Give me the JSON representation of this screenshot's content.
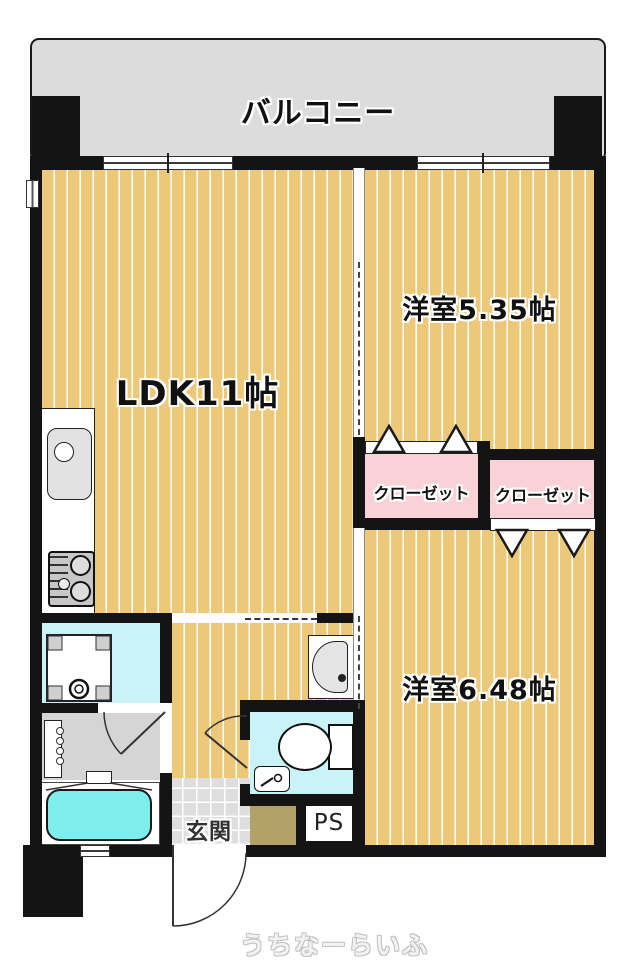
{
  "floorplan": {
    "balcony": {
      "label": "バルコニー"
    },
    "rooms": {
      "ldk": {
        "label": "LDK11帖"
      },
      "western1": {
        "label": "洋室5.35帖"
      },
      "western2": {
        "label": "洋室6.48帖"
      },
      "closet1": {
        "label": "クローゼット"
      },
      "closet2": {
        "label": "クローゼット"
      },
      "entrance": {
        "label": "玄関"
      },
      "pipe_space": {
        "label": "PS"
      }
    },
    "fixtures": [
      "kitchen-sink",
      "gas-stove",
      "washing-machine-pan",
      "vanity",
      "bathtub",
      "toilet",
      "corner-hand-sink",
      "hall-washbasin"
    ],
    "watermark": "うちなーらいふ",
    "colors": {
      "floor_wood": "#ecc878",
      "balcony_gray": "#dcdcdc",
      "closet_pink": "#f8d2d6",
      "bathtub_cyan": "#7deeec",
      "wet_floor_cyan": "#c9f3f7",
      "washroom_gray": "#d5d5d5",
      "entrance_tile": "#dedede",
      "shoe_cabinet_brown": "#b2a267",
      "wall_black": "#141414"
    }
  }
}
